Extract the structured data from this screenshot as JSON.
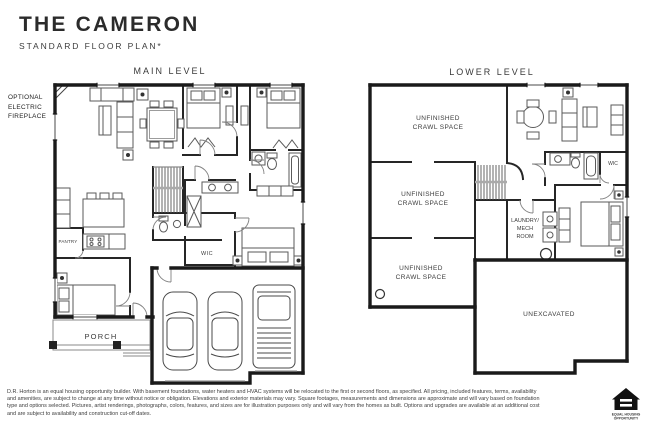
{
  "header": {
    "title": "THE CAMERON",
    "subtitle": "STANDARD FLOOR PLAN*"
  },
  "annotations": {
    "fireplace_line1": "OPTIONAL",
    "fireplace_line2": "ELECTRIC",
    "fireplace_line3": "FIREPLACE"
  },
  "main_level": {
    "label": "MAIN LEVEL",
    "rooms": {
      "pantry": "PANTRY",
      "wic": "WIC",
      "porch": "PORCH"
    }
  },
  "lower_level": {
    "label": "LOWER LEVEL",
    "rooms": {
      "crawl_top_line1": "UNFINISHED",
      "crawl_top_line2": "CRAWL SPACE",
      "crawl_mid_line1": "UNFINISHED",
      "crawl_mid_line2": "CRAWL SPACE",
      "crawl_bottom_line1": "UNFINISHED",
      "crawl_bottom_line2": "CRAWL SPACE",
      "laundry_line1": "LAUNDRY/",
      "laundry_line2": "MECH",
      "laundry_line3": "ROOM",
      "wic": "WIC",
      "unexcavated": "UNEXCAVATED"
    }
  },
  "disclaimer": {
    "line1": "D.R. Horton is an equal housing opportunity builder. With basement foundations, water heaters and HVAC systems will be relocated to the first or second floors, as specified. All pricing, included features, terms, availability",
    "line2": "and amenities, are subject to change at any time without notice or obligation. Elevations and exterior materials may vary. Square footages, measurements and dimensions are approximate and will vary based on foundation",
    "line3": "type and options selected. Pictures, artist renderings, photographs, colors, features, and sizes are for illustration purposes only and will vary from the homes as built. Options and upgrades are available at an additional cost",
    "line4": "and are subject to availability and construction cut-off dates."
  },
  "logo": {
    "line1": "EQUAL HOUSING",
    "line2": "OPPORTUNITY"
  }
}
